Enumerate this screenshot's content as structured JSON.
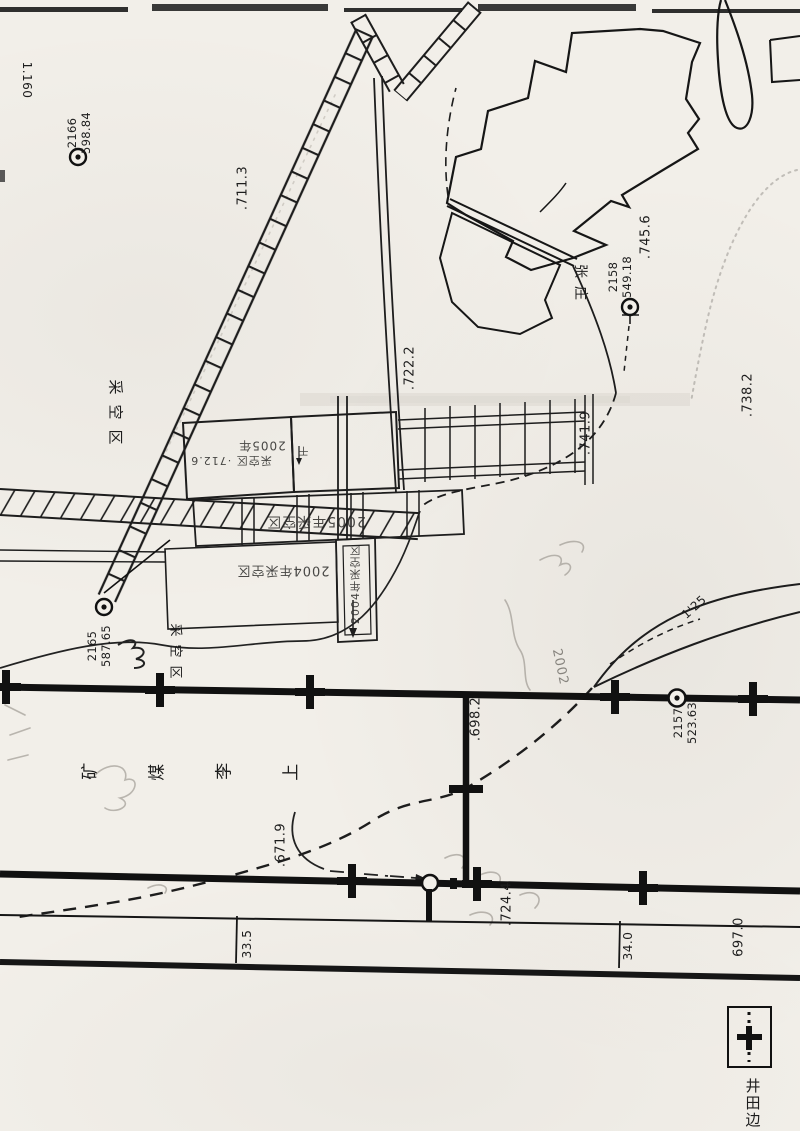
{
  "map": {
    "corner_ref": "1.160",
    "symbols": {
      "survey_point": "circled-dot",
      "grid_cross": "bold-cross",
      "legend_sample": "boundary-grid-cross"
    },
    "survey_points": [
      {
        "id": "2166",
        "elevation": "598.84"
      },
      {
        "id": "2158",
        "elevation": "549.18"
      },
      {
        "id": "2165",
        "elevation": "587.65"
      },
      {
        "id": "2157",
        "elevation": "523.63"
      }
    ],
    "spot_elevations": [
      ".711.3",
      ".722.2",
      ".745.6",
      ".741.9",
      ".738.2",
      ".698.2",
      ".671.9",
      ".724.4",
      "697.0"
    ],
    "distance_labels": [
      "33.5",
      "34.0"
    ],
    "place_names": {
      "village": "张庄",
      "mine": "上李煤矿",
      "mine_chars": [
        "上",
        "李",
        "煤",
        "矿"
      ]
    },
    "area_labels": [
      "采空区",
      "采空区"
    ],
    "road_label": "1'25",
    "handwritten_notes": [
      {
        "text": "2005年"
      },
      {
        "text": "采空区 ·712.6"
      },
      {
        "text": "2005年采空区"
      },
      {
        "text": "2004年采空区"
      },
      {
        "text": "2004年采空区"
      },
      {
        "text": "干"
      },
      {
        "text": "2002"
      }
    ],
    "legend": {
      "boundary_label": "井田边"
    }
  }
}
